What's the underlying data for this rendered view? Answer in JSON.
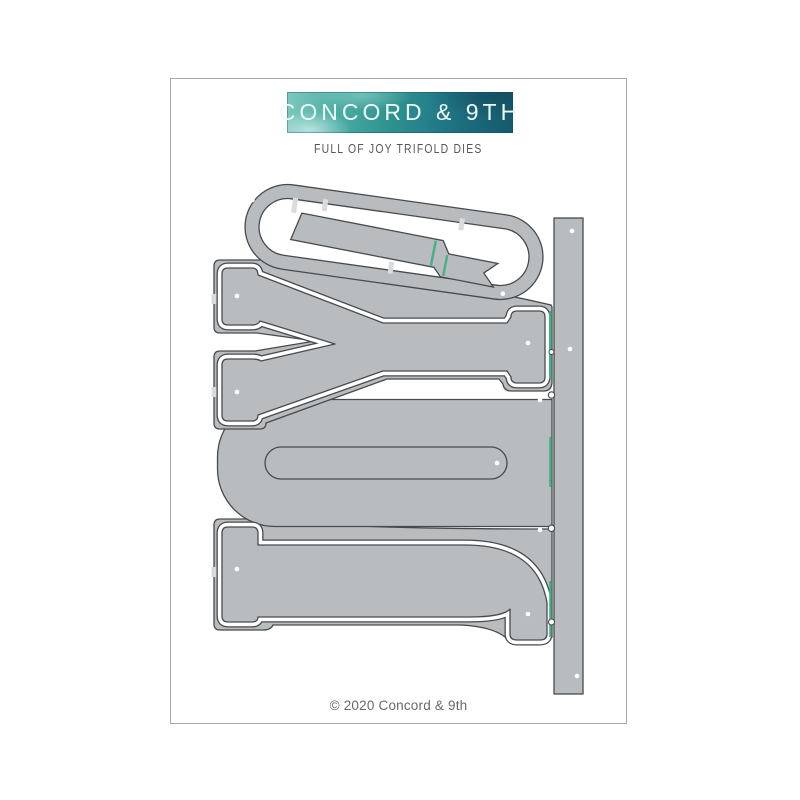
{
  "brand": {
    "name": "CONCORD & 9TH",
    "logo_colors": [
      "#7ec9bd",
      "#30938f",
      "#16596c"
    ],
    "text_color": "#eefaf7"
  },
  "product": {
    "title": "FULL OF JOY TRIFOLD DIES",
    "title_color": "#54585c"
  },
  "footer": {
    "copyright": "© 2020 Concord & 9th",
    "color": "#66696d"
  },
  "dies": {
    "fill": "#b9bcbe",
    "outline": "#474b4e",
    "score_line_color": "#44b183",
    "pin_hole_color": "#ffffff",
    "connector_tab_color": "#d9dbdc",
    "pieces": [
      "O ring outline die",
      "banner ribbon die",
      "JOY trifold base plate",
      "J outline die",
      "Y outline die",
      "spine strip die"
    ],
    "word": "JOY",
    "orientation": "rotated 90 degrees counterclockwise"
  },
  "page": {
    "background": "#ffffff",
    "border_color": "#a7aaac"
  }
}
